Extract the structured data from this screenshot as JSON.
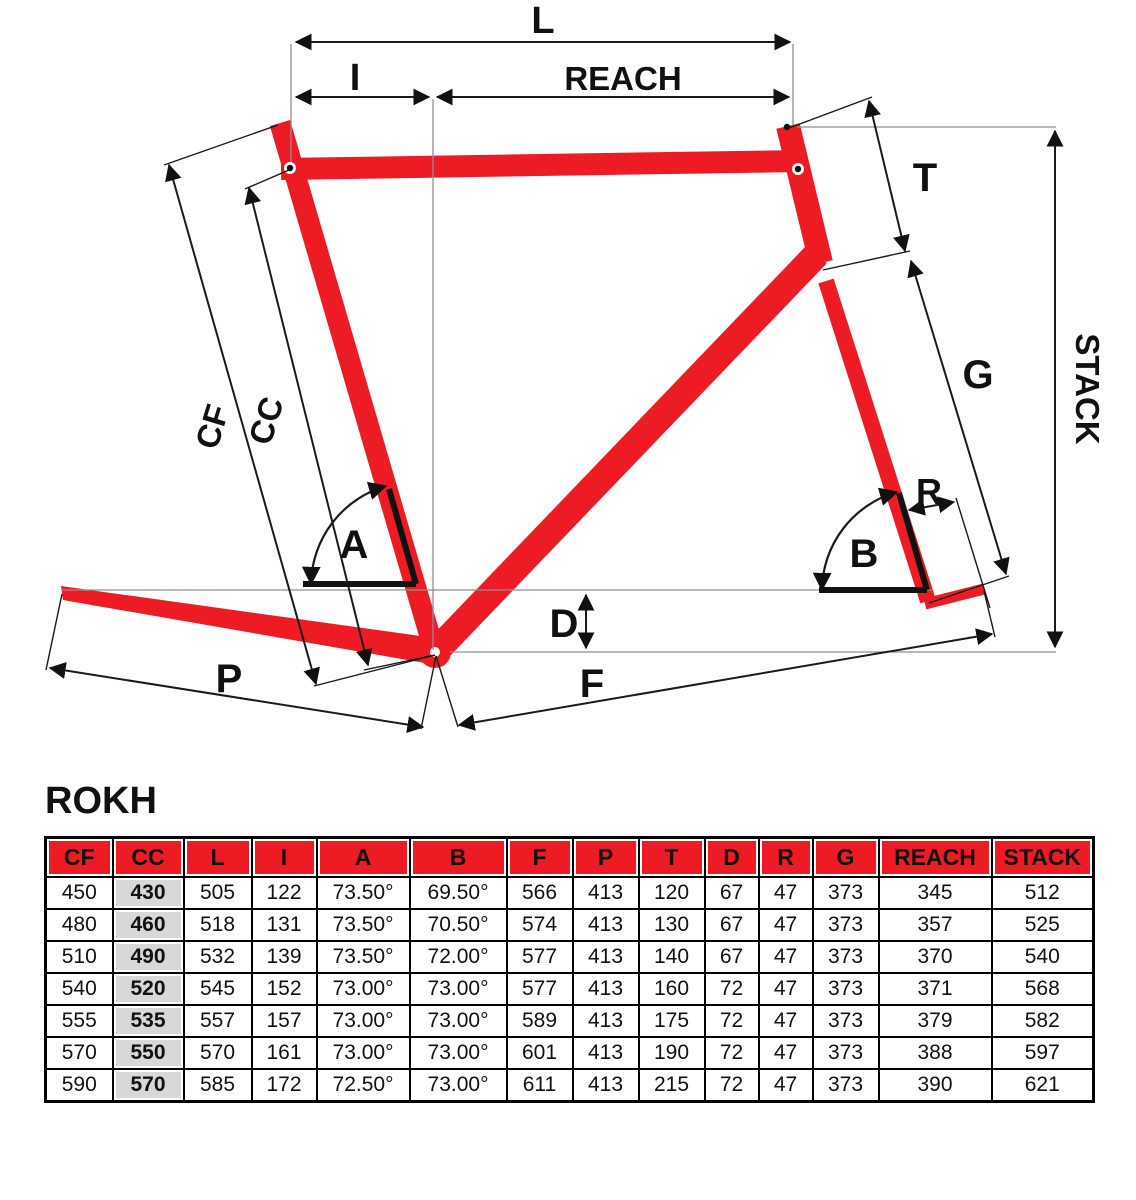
{
  "title": "ROKH",
  "diagram": {
    "frame_color": "#ED1C24",
    "labels": {
      "L": "L",
      "I": "I",
      "REACH": "REACH",
      "T": "T",
      "G": "G",
      "STACK": "STACK",
      "R": "R",
      "B": "B",
      "A": "A",
      "D": "D",
      "F": "F",
      "P": "P",
      "CF": "CF",
      "CC": "CC"
    }
  },
  "table": {
    "columns": [
      "CF",
      "CC",
      "L",
      "I",
      "A",
      "B",
      "F",
      "P",
      "T",
      "D",
      "R",
      "G",
      "REACH",
      "STACK"
    ],
    "highlight_column_index": 1,
    "header_bg": "#ED1C24",
    "highlight_bg": "#D8D8D8",
    "rows": [
      [
        "450",
        "430",
        "505",
        "122",
        "73.50°",
        "69.50°",
        "566",
        "413",
        "120",
        "67",
        "47",
        "373",
        "345",
        "512"
      ],
      [
        "480",
        "460",
        "518",
        "131",
        "73.50°",
        "70.50°",
        "574",
        "413",
        "130",
        "67",
        "47",
        "373",
        "357",
        "525"
      ],
      [
        "510",
        "490",
        "532",
        "139",
        "73.50°",
        "72.00°",
        "577",
        "413",
        "140",
        "67",
        "47",
        "373",
        "370",
        "540"
      ],
      [
        "540",
        "520",
        "545",
        "152",
        "73.00°",
        "73.00°",
        "577",
        "413",
        "160",
        "72",
        "47",
        "373",
        "371",
        "568"
      ],
      [
        "555",
        "535",
        "557",
        "157",
        "73.00°",
        "73.00°",
        "589",
        "413",
        "175",
        "72",
        "47",
        "373",
        "379",
        "582"
      ],
      [
        "570",
        "550",
        "570",
        "161",
        "73.00°",
        "73.00°",
        "601",
        "413",
        "190",
        "72",
        "47",
        "373",
        "388",
        "597"
      ],
      [
        "590",
        "570",
        "585",
        "172",
        "72.50°",
        "73.00°",
        "611",
        "413",
        "215",
        "72",
        "47",
        "373",
        "390",
        "621"
      ]
    ]
  }
}
